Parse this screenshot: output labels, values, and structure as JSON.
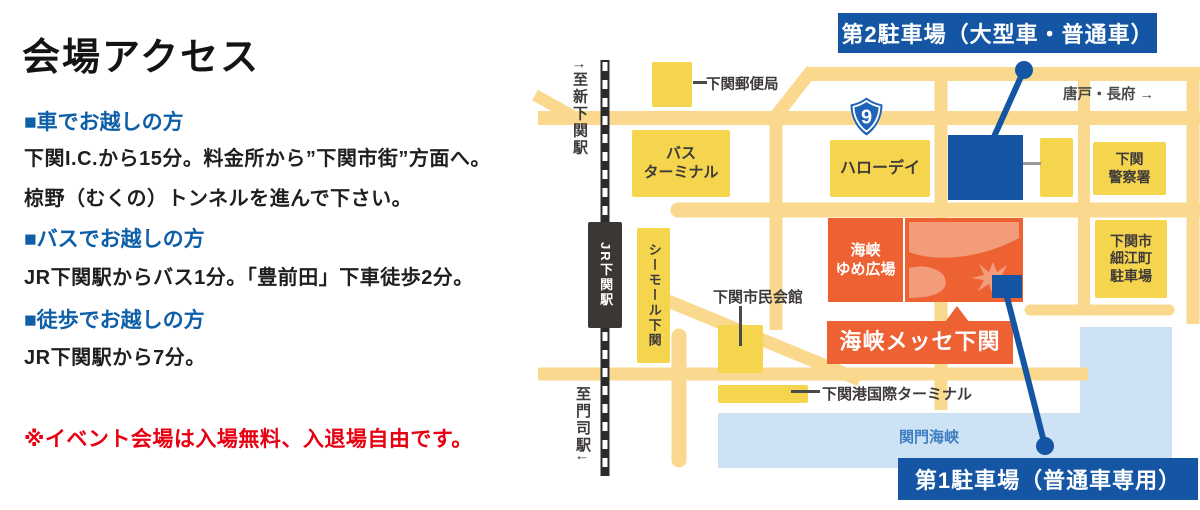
{
  "left_panel": {
    "title": "会場アクセス",
    "sections": [
      {
        "heading": "■車でお越しの方",
        "line1": "下関I.C.から15分。料金所から”下関市街”方面へ。",
        "line2": "椋野（むくの）トンネルを進んで下さい。"
      },
      {
        "heading": "■バスでお越しの方",
        "line1": "JR下関駅からバス1分。「豊前田」下車徒歩2分。"
      },
      {
        "heading": "■徒歩でお越しの方",
        "line1": "JR下関駅から7分。"
      }
    ],
    "note": "※イベント会場は入場無料、入退場自由です。"
  },
  "map": {
    "badges": {
      "parking2": "第2駐車場（大型車・普通車）",
      "parking1": "第1駐車場（普通車専用）"
    },
    "route_shield": "9",
    "directions": {
      "north": "↑至新下関駅",
      "south": "至門司駅↓",
      "east": "唐戸・長府 →"
    },
    "labels": {
      "post_office": "下関郵便局",
      "bus_terminal": "バス\nターミナル",
      "hello_day": "ハローデイ",
      "police": "下関\n警察署",
      "hosoe_parking": "下関市\n細江町\n駐車場",
      "seamall": "シーモール下関",
      "jr_station": "JR下関駅",
      "yume_plaza": "海峡\nゆめ広場",
      "messe": "海峡メッセ下関",
      "citizens_hall": "下関市民会館",
      "ferry_terminal": "下関港国際ターミナル",
      "sea": "関門海峡"
    },
    "colors": {
      "road": "#FAD98E",
      "building_yellow": "#F5D44E",
      "venue_orange": "#ED6133",
      "venue_orange_light": "#F29C79",
      "parking_blue": "#1456A4",
      "sea_blue": "#CDE3F5",
      "heading_blue": "#0D5FA8",
      "note_red": "#E60012"
    }
  }
}
